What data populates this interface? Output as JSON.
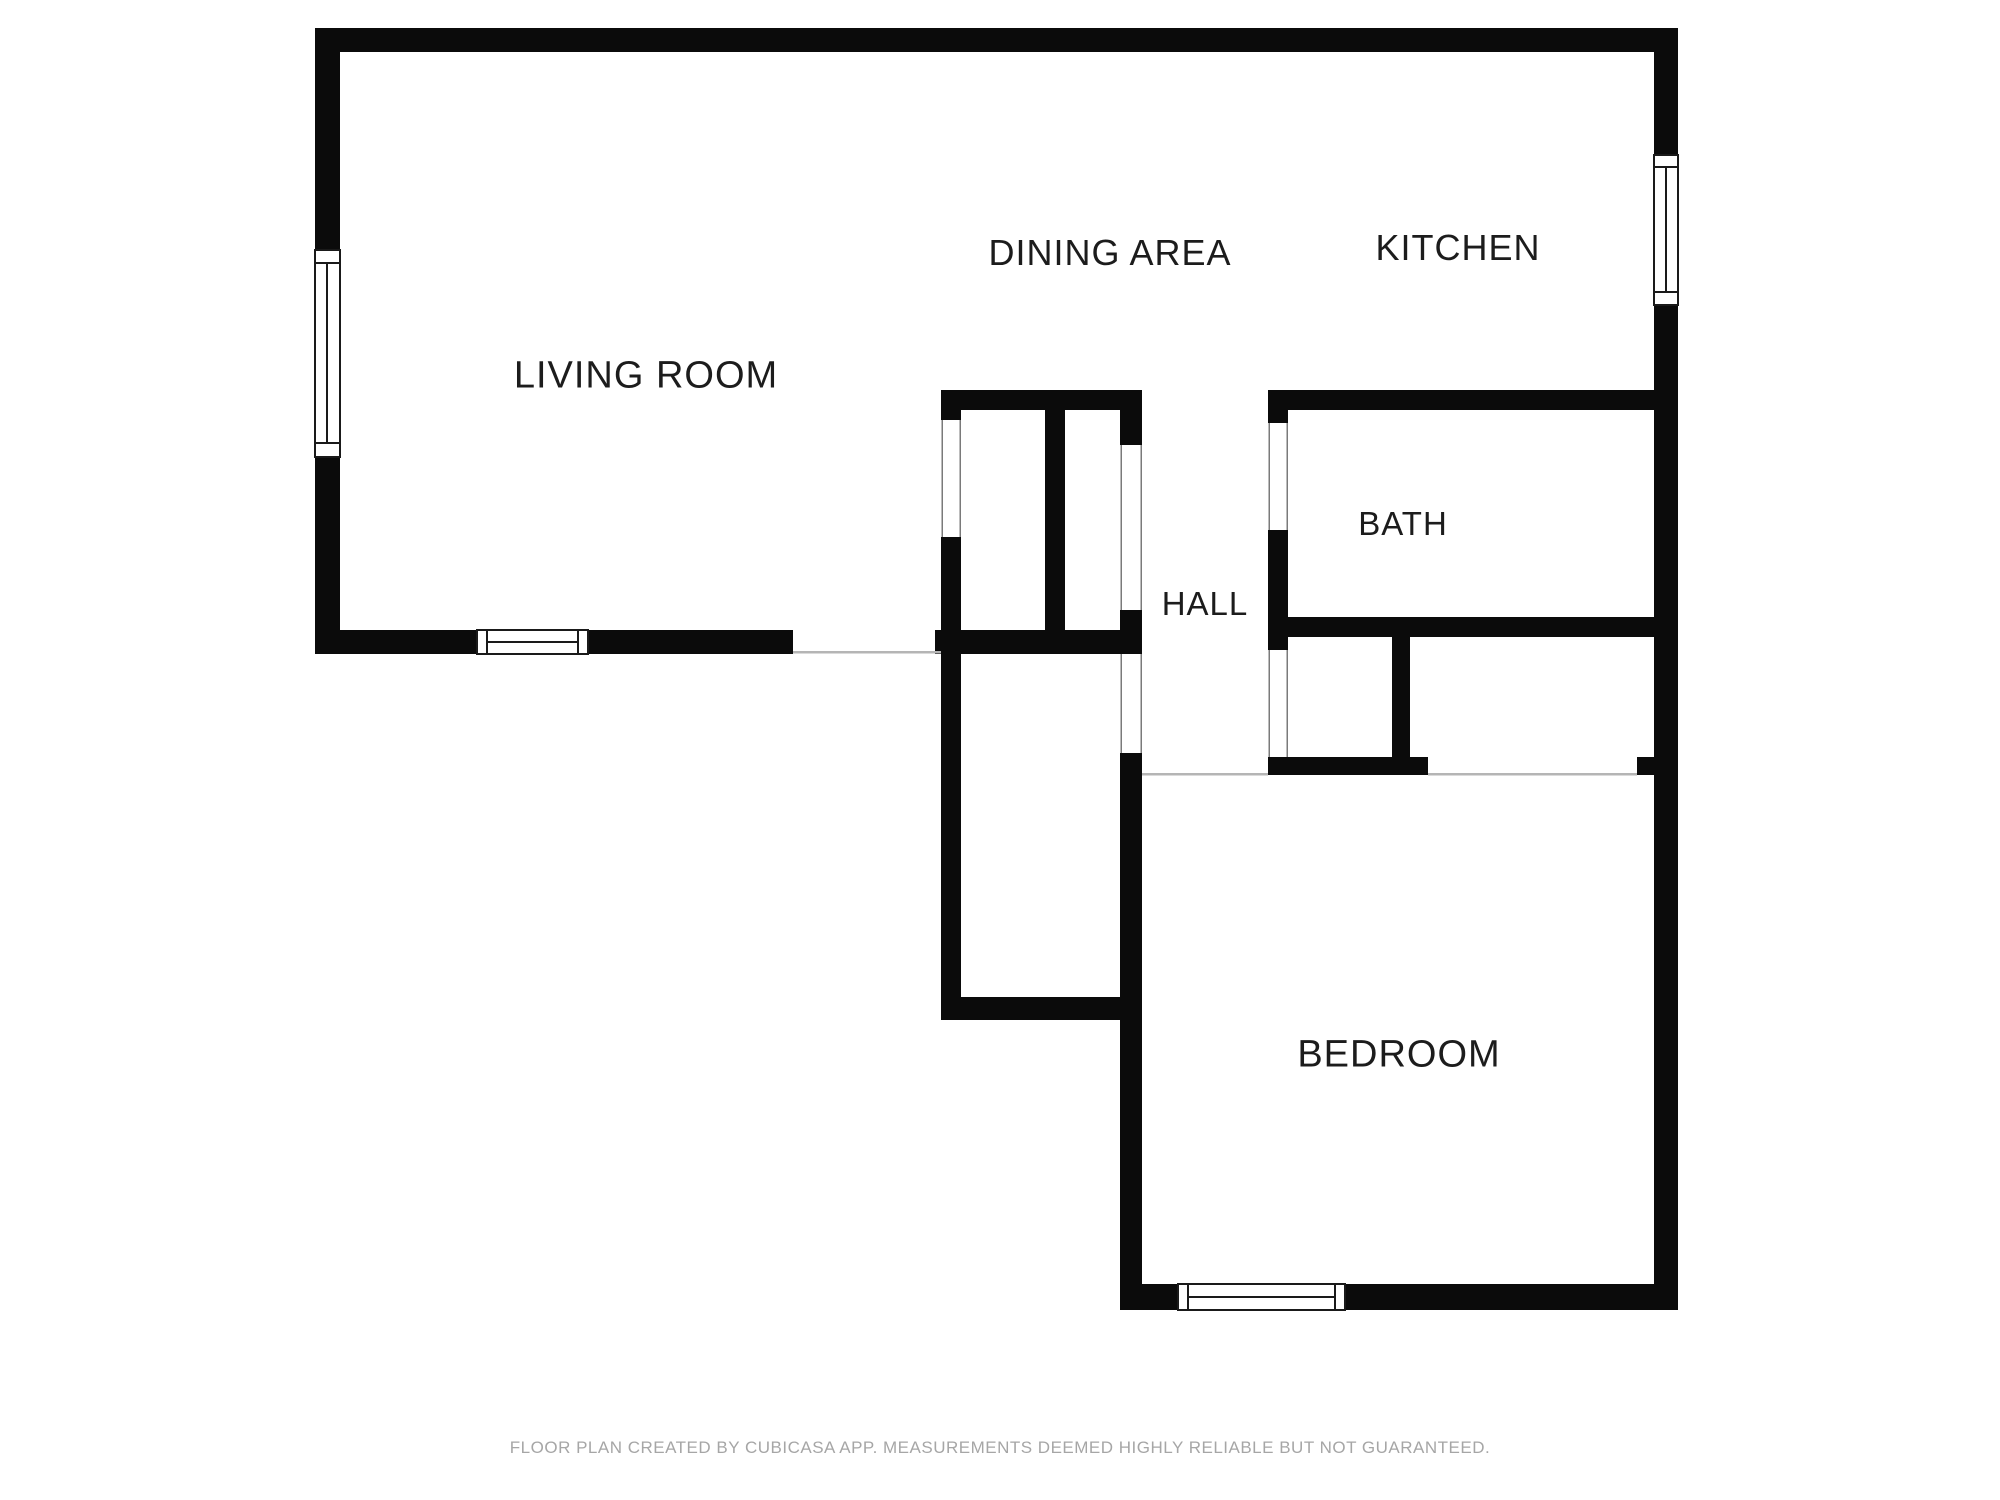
{
  "rooms": [
    {
      "name": "living-room",
      "label": "LIVING ROOM"
    },
    {
      "name": "dining-area",
      "label": "DINING AREA"
    },
    {
      "name": "kitchen",
      "label": "KITCHEN"
    },
    {
      "name": "bath",
      "label": "BATH"
    },
    {
      "name": "hall",
      "label": "HALL"
    },
    {
      "name": "bedroom",
      "label": "BEDROOM"
    }
  ],
  "footer": {
    "text": "FLOOR PLAN CREATED BY CUBICASA APP. MEASUREMENTS DEEMED HIGHLY RELIABLE BUT NOT GUARANTEED."
  },
  "colors": {
    "background": "#ffffff",
    "wall": "#0b0b0b",
    "window_border": "#1a1a1a",
    "opening_line": "#b5b5b5",
    "door_edge_line": "#7a7a7a",
    "label_text": "#1c1c1c",
    "footer_text": "#a6a6a6"
  }
}
